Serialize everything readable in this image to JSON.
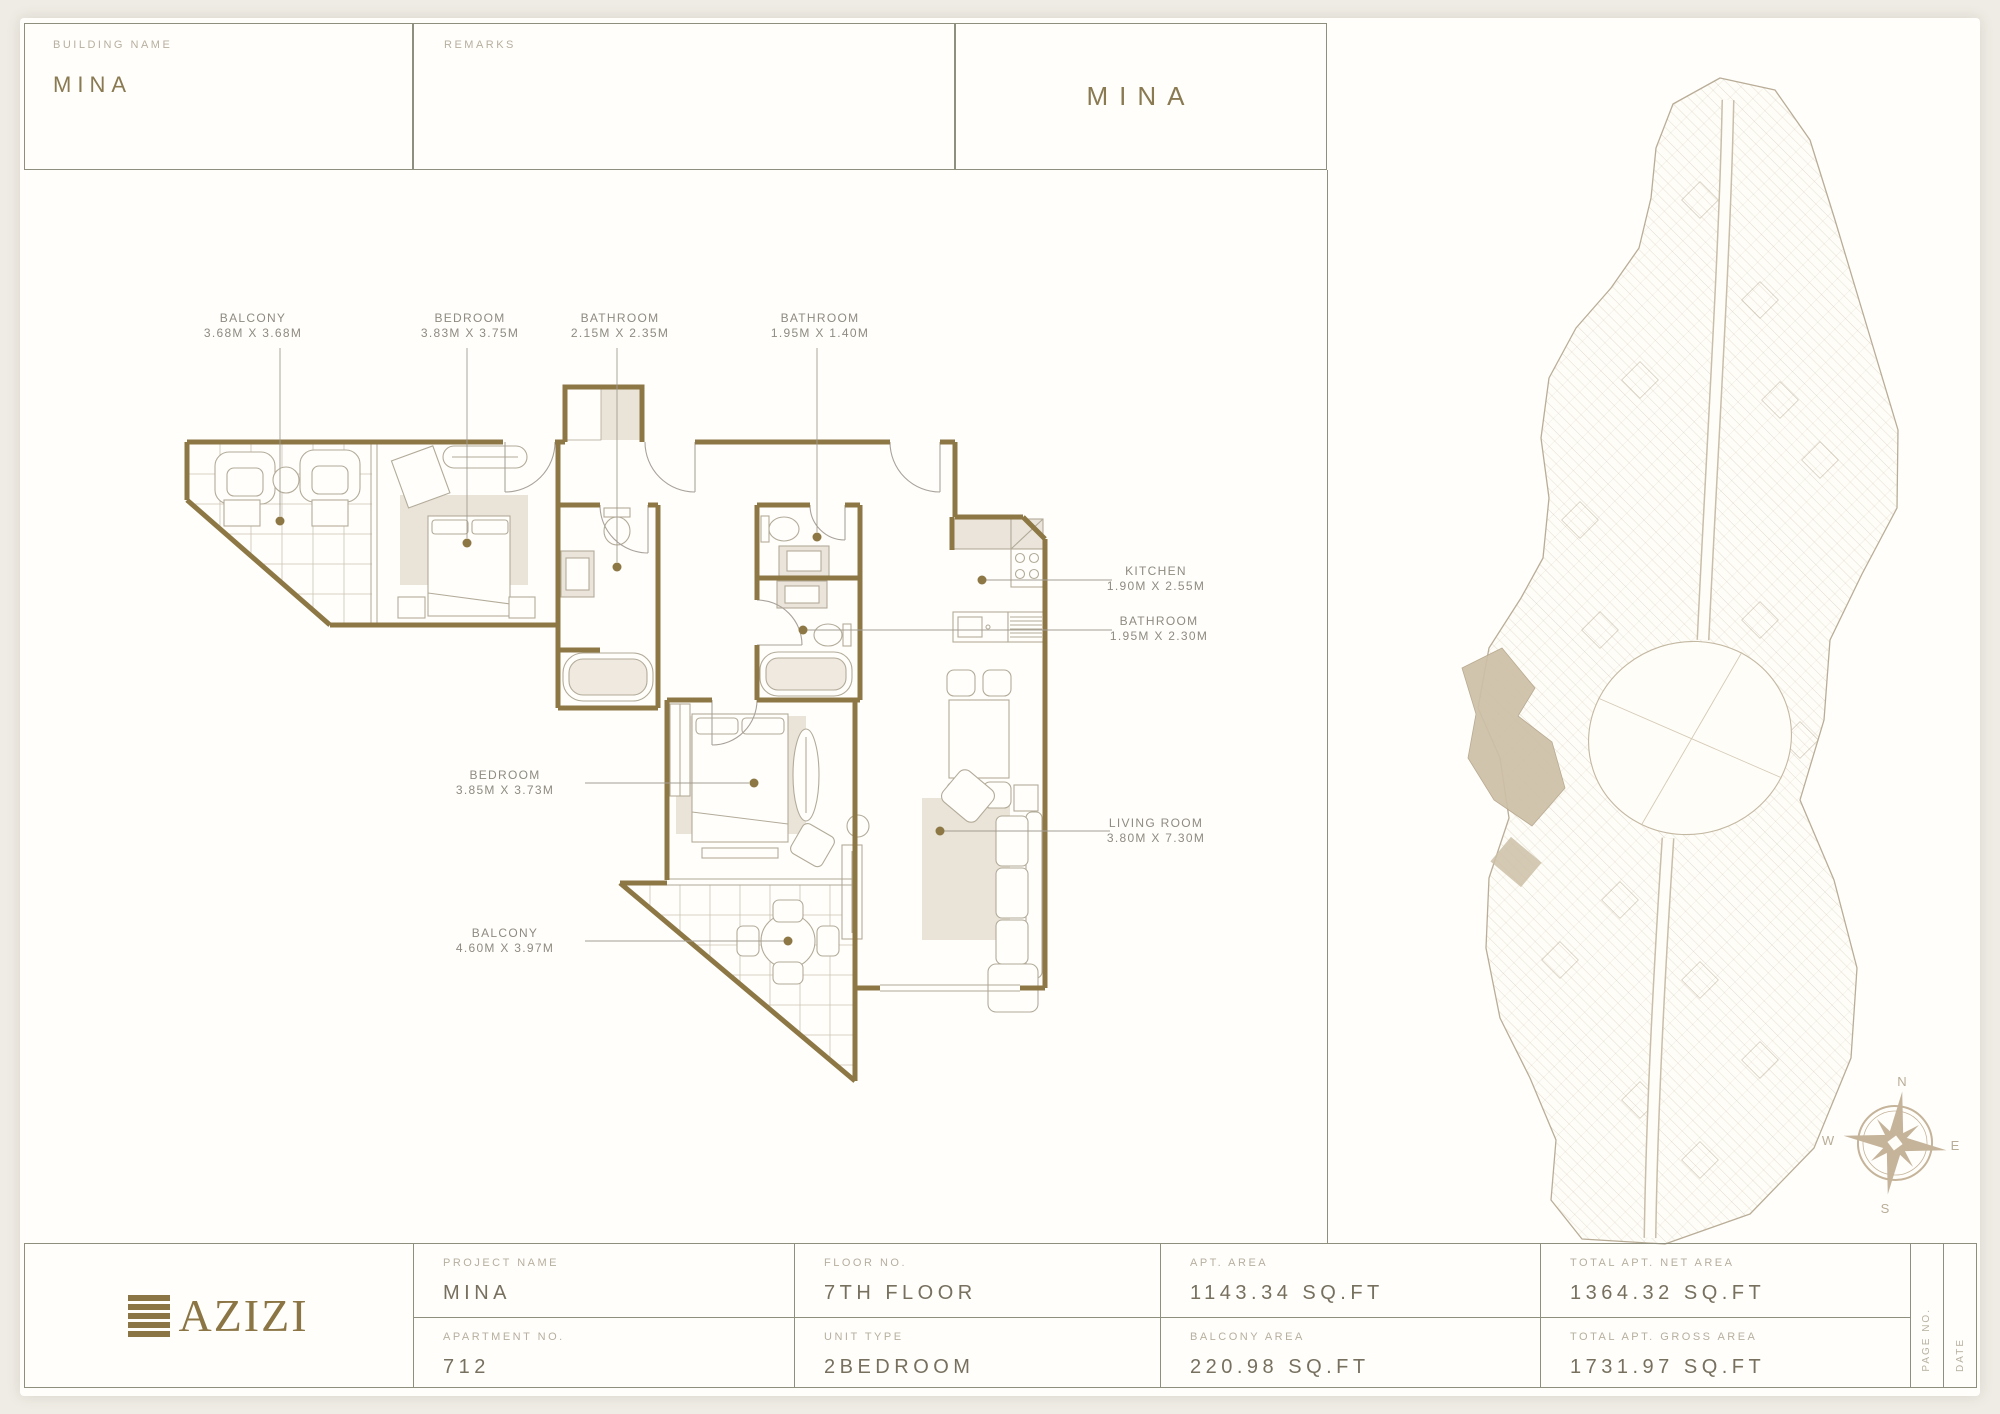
{
  "header": {
    "building_name_label": "BUILDING NAME",
    "building_name_value": "MINA",
    "remarks_label": "REMARKS",
    "brand": "MINA"
  },
  "floor_plan": {
    "labels": [
      {
        "name": "BALCONY",
        "dims": "3.68M X 3.68M"
      },
      {
        "name": "BEDROOM",
        "dims": "3.83M X 3.75M"
      },
      {
        "name": "BATHROOM",
        "dims": "2.15M X 2.35M"
      },
      {
        "name": "BATHROOM",
        "dims": "1.95M X 1.40M"
      },
      {
        "name": "KITCHEN",
        "dims": "1.90M X 2.55M"
      },
      {
        "name": "BATHROOM",
        "dims": "1.95M X 2.30M"
      },
      {
        "name": "LIVING ROOM",
        "dims": "3.80M X 7.30M"
      },
      {
        "name": "BEDROOM",
        "dims": "3.85M X 3.73M"
      },
      {
        "name": "BALCONY",
        "dims": "4.60M X 3.97M"
      }
    ]
  },
  "site_plan": {
    "compass": {
      "n": "N",
      "e": "E",
      "s": "S",
      "w": "W"
    }
  },
  "footer": {
    "brand": "AZIZI",
    "project_name": {
      "label": "PROJECT NAME",
      "value": "MINA"
    },
    "floor_no": {
      "label": "FLOOR NO.",
      "value": "7TH FLOOR"
    },
    "apt_area": {
      "label": "APT. AREA",
      "value": "1143.34 SQ.FT"
    },
    "total_net": {
      "label": "TOTAL APT. NET AREA",
      "value": "1364.32 SQ.FT"
    },
    "apartment_no": {
      "label": "APARTMENT NO.",
      "value": "712"
    },
    "unit_type": {
      "label": "UNIT TYPE",
      "value": "2BEDROOM"
    },
    "balcony_area": {
      "label": "BALCONY AREA",
      "value": "220.98 SQ.FT"
    },
    "total_gross": {
      "label": "TOTAL APT. GROSS AREA",
      "value": "1731.97 SQ.FT"
    },
    "page_no_label": "PAGE NO.",
    "date_label": "DATE"
  },
  "colors": {
    "gold_accent": "#8a7a52",
    "wall": "#8d7845",
    "border_line": "#8f8f7d",
    "label_gray": "#b7af9f",
    "value_gray": "#77705f",
    "beige_fill": "#e9e3d8",
    "site_tan": "#b9ad97"
  }
}
